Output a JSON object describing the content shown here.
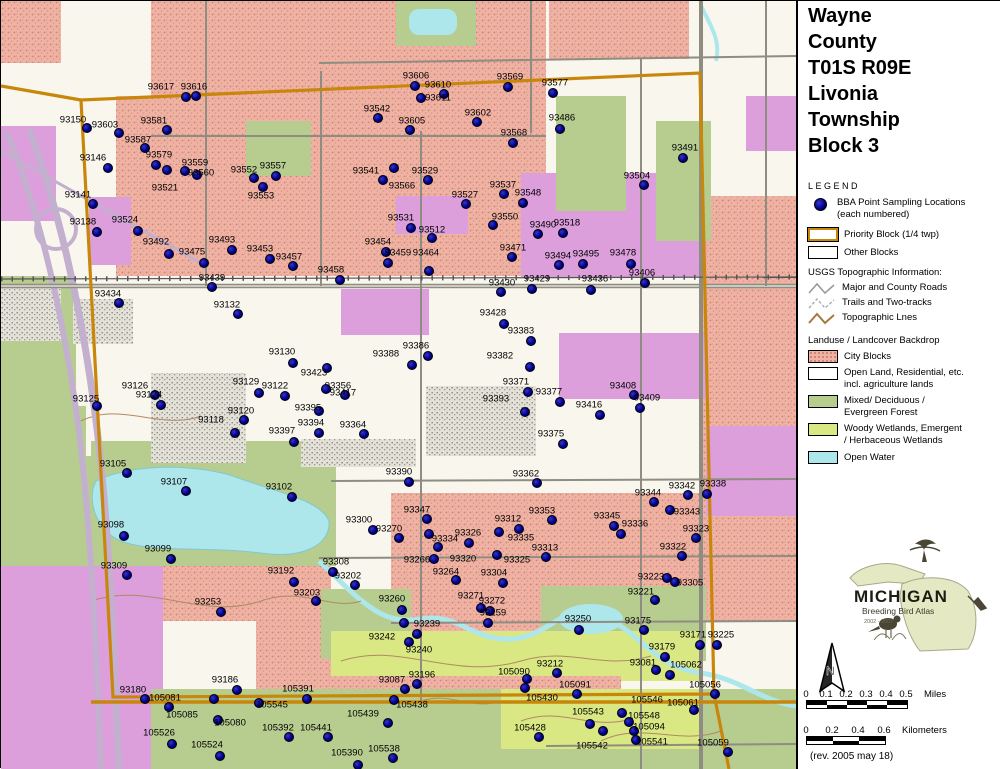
{
  "title": {
    "lines": [
      "Wayne",
      "County",
      "T01S R09E",
      "Livonia",
      "Township",
      "Block 3"
    ]
  },
  "legend": {
    "heading": "LEGEND",
    "points_label_line1": "BBA Point Sampling Locations",
    "points_label_line2": "(each numbered)",
    "priority_block_label": "Priority Block (1/4 twp)",
    "other_blocks_label": "Other Blocks",
    "usgs_heading": "USGS Topographic Information:",
    "usgs_items": [
      {
        "icon": "road-zigzag-icon",
        "label": "Major and County Roads"
      },
      {
        "icon": "trail-zigzag-icon",
        "label": "Trails and Two-tracks"
      },
      {
        "icon": "topo-zigzag-icon",
        "label": "Topographic Lnes"
      }
    ],
    "landuse_heading": "Landuse / Landcover Backdrop",
    "landuse_items": [
      {
        "swatch": "city-blocks",
        "line1": "City Blocks",
        "line2": ""
      },
      {
        "swatch": "open-land",
        "line1": "Open Land, Residential, etc.",
        "line2": "incl. agriculture lands"
      },
      {
        "swatch": "forest",
        "line1": "Mixed/ Deciduous /",
        "line2": "Evergreen Forest"
      },
      {
        "swatch": "wetland",
        "line1": "Woody Wetlands, Emergent",
        "line2": "/ Herbaceous Wetlands"
      },
      {
        "swatch": "open-water",
        "line1": "Open Water",
        "line2": ""
      }
    ]
  },
  "logo": {
    "name": "MICHIGAN",
    "subtitle": "Breeding Bird Atlas",
    "years": "2002 - 2007"
  },
  "north_arrow_label": "N",
  "scale": {
    "miles": {
      "ticks": [
        "0",
        "0.1",
        "0.2",
        "0.3",
        "0.4",
        "0.5"
      ],
      "unit": "Miles",
      "spacing": 20
    },
    "km": {
      "ticks": [
        "0",
        "0.2",
        "0.4",
        "0.6"
      ],
      "unit": "Kilometers",
      "spacing": 26
    }
  },
  "revision": "(rev. 2005 may 18)",
  "colors": {
    "map_background": "#f9f6ee",
    "city_blocks": "#f0b2a3",
    "city_speckle": "#d08275",
    "violet_blocks": "#dc9fdc",
    "forest": "#b7cd90",
    "wetland": "#d9e883",
    "open_water": "#ade7ec",
    "road_gray": "#8f8c82",
    "topo_brown": "#b08a64",
    "priority_boundary_orange": "#c8860a",
    "sample_point_blue": "#00008b"
  },
  "map": {
    "points": [
      [
        "93617",
        185,
        96,
        160,
        86
      ],
      [
        "93616",
        195,
        95,
        193,
        86
      ],
      [
        "93150",
        86,
        127,
        72,
        119
      ],
      [
        "93603",
        118,
        132,
        104,
        124
      ],
      [
        "93581",
        166,
        129,
        153,
        120
      ],
      [
        "93587",
        144,
        147,
        137,
        139
      ],
      [
        "93146",
        107,
        167,
        92,
        157
      ],
      [
        "93579",
        155,
        164,
        158,
        154
      ],
      [
        "93559",
        184,
        170,
        194,
        162
      ],
      [
        "93560",
        196,
        174,
        200,
        172
      ],
      [
        "93552",
        253,
        177,
        243,
        169
      ],
      [
        "93557",
        275,
        175,
        272,
        165
      ],
      [
        "93553",
        262,
        186,
        260,
        195
      ],
      [
        "93521",
        166,
        169,
        164,
        187
      ],
      [
        "93141",
        92,
        203,
        77,
        194
      ],
      [
        "93138",
        96,
        231,
        82,
        221
      ],
      [
        "93524",
        137,
        230,
        124,
        219
      ],
      [
        "93606",
        414,
        85,
        415,
        75
      ],
      [
        "93610",
        443,
        93,
        437,
        84
      ],
      [
        "93611",
        420,
        97,
        437,
        97
      ],
      [
        "93542",
        377,
        117,
        376,
        108
      ],
      [
        "93605",
        409,
        129,
        411,
        120
      ],
      [
        "93602",
        476,
        121,
        477,
        112
      ],
      [
        "93569",
        507,
        86,
        509,
        76
      ],
      [
        "93577",
        552,
        92,
        554,
        82
      ],
      [
        "93486",
        559,
        128,
        561,
        117
      ],
      [
        "93568",
        512,
        142,
        513,
        132
      ],
      [
        "93491",
        682,
        157,
        684,
        147
      ],
      [
        "93504",
        643,
        184,
        636,
        175
      ],
      [
        "93541",
        393,
        167,
        365,
        170
      ],
      [
        "93566",
        382,
        179,
        401,
        185
      ],
      [
        "93529",
        427,
        179,
        424,
        170
      ],
      [
        "93537",
        503,
        193,
        502,
        184
      ],
      [
        "93527",
        465,
        203,
        464,
        194
      ],
      [
        "93548",
        522,
        202,
        527,
        192
      ],
      [
        "93550",
        492,
        224,
        504,
        216
      ],
      [
        "93531",
        410,
        227,
        400,
        217
      ],
      [
        "93512",
        431,
        237,
        431,
        229
      ],
      [
        "93490",
        537,
        233,
        542,
        224
      ],
      [
        "93518",
        562,
        232,
        566,
        222
      ],
      [
        "93471",
        511,
        256,
        512,
        247
      ],
      [
        "93454",
        385,
        251,
        377,
        241
      ],
      [
        "93459",
        387,
        262,
        397,
        252
      ],
      [
        "93464",
        428,
        270,
        425,
        252
      ],
      [
        "93458",
        339,
        279,
        330,
        269
      ],
      [
        "93494",
        558,
        264,
        557,
        255
      ],
      [
        "93495",
        582,
        263,
        585,
        253
      ],
      [
        "93429",
        531,
        288,
        536,
        278
      ],
      [
        "93430",
        500,
        291,
        501,
        282
      ],
      [
        "93478",
        630,
        263,
        622,
        252
      ],
      [
        "93436",
        590,
        289,
        594,
        278
      ],
      [
        "93406",
        644,
        282,
        641,
        272
      ],
      [
        "93492",
        168,
        253,
        155,
        241
      ],
      [
        "93475",
        203,
        262,
        191,
        251
      ],
      [
        "93493",
        231,
        249,
        221,
        239
      ],
      [
        "93453",
        269,
        258,
        259,
        248
      ],
      [
        "93457",
        292,
        265,
        288,
        256
      ],
      [
        "93439",
        211,
        286,
        211,
        277
      ],
      [
        "93434",
        118,
        302,
        107,
        293
      ],
      [
        "93132",
        237,
        313,
        226,
        304
      ],
      [
        "93130",
        292,
        362,
        281,
        351
      ],
      [
        "93129",
        258,
        392,
        245,
        381
      ],
      [
        "93122",
        284,
        395,
        274,
        385
      ],
      [
        "93126",
        154,
        394,
        134,
        385
      ],
      [
        "93124",
        160,
        404,
        148,
        394
      ],
      [
        "93125",
        96,
        405,
        85,
        398
      ],
      [
        "93120",
        243,
        419,
        240,
        410
      ],
      [
        "93118",
        234,
        432,
        210,
        419
      ],
      [
        "93423",
        326,
        367,
        313,
        372
      ],
      [
        "93356",
        344,
        394,
        337,
        385
      ],
      [
        "93417",
        325,
        388,
        342,
        392
      ],
      [
        "93395",
        318,
        410,
        307,
        407
      ],
      [
        "93394",
        318,
        432,
        310,
        422
      ],
      [
        "93397",
        293,
        441,
        281,
        430
      ],
      [
        "93364",
        363,
        433,
        352,
        424
      ],
      [
        "93386",
        427,
        355,
        415,
        345
      ],
      [
        "93388",
        411,
        364,
        385,
        353
      ],
      [
        "93383",
        530,
        340,
        520,
        330
      ],
      [
        "93382",
        529,
        366,
        499,
        355
      ],
      [
        "93428",
        503,
        323,
        492,
        312
      ],
      [
        "93371",
        527,
        391,
        515,
        381
      ],
      [
        "93377",
        559,
        401,
        548,
        391
      ],
      [
        "93393",
        524,
        411,
        495,
        398
      ],
      [
        "93375",
        562,
        443,
        550,
        433
      ],
      [
        "93362",
        536,
        482,
        525,
        473
      ],
      [
        "93390",
        408,
        481,
        398,
        471
      ],
      [
        "93408",
        633,
        394,
        622,
        385
      ],
      [
        "93409",
        639,
        407,
        646,
        397
      ],
      [
        "93416",
        599,
        414,
        588,
        404
      ],
      [
        "93105",
        126,
        472,
        112,
        463
      ],
      [
        "93107",
        185,
        490,
        173,
        481
      ],
      [
        "93102",
        291,
        496,
        278,
        486
      ],
      [
        "93098",
        123,
        535,
        110,
        524
      ],
      [
        "93099",
        170,
        558,
        157,
        548
      ],
      [
        "93309",
        126,
        574,
        113,
        565
      ],
      [
        "93192",
        293,
        581,
        280,
        570
      ],
      [
        "93203",
        315,
        600,
        306,
        592
      ],
      [
        "93253",
        220,
        611,
        207,
        601
      ],
      [
        "93300",
        372,
        529,
        358,
        519
      ],
      [
        "93270",
        398,
        537,
        388,
        528
      ],
      [
        "93347",
        426,
        518,
        416,
        509
      ],
      [
        "93312",
        518,
        528,
        507,
        518
      ],
      [
        "93353",
        551,
        519,
        541,
        510
      ],
      [
        "93334",
        428,
        533,
        444,
        538
      ],
      [
        "93326",
        468,
        542,
        467,
        532
      ],
      [
        "93335",
        498,
        531,
        520,
        537
      ],
      [
        "93313",
        545,
        556,
        544,
        547
      ],
      [
        "93266",
        433,
        558,
        416,
        559
      ],
      [
        "93320",
        437,
        546,
        462,
        558
      ],
      [
        "93325",
        496,
        554,
        516,
        559
      ],
      [
        "93264",
        455,
        579,
        445,
        571
      ],
      [
        "93304",
        502,
        582,
        493,
        572
      ],
      [
        "93308",
        332,
        571,
        335,
        561
      ],
      [
        "93202",
        354,
        584,
        347,
        575
      ],
      [
        "93260",
        401,
        609,
        391,
        598
      ],
      [
        "93271",
        480,
        607,
        470,
        595
      ],
      [
        "93272",
        489,
        610,
        491,
        600
      ],
      [
        "93259",
        487,
        622,
        492,
        612
      ],
      [
        "93239",
        403,
        622,
        426,
        623
      ],
      [
        "93250",
        578,
        629,
        577,
        618
      ],
      [
        "93242",
        408,
        641,
        381,
        636
      ],
      [
        "93240",
        416,
        633,
        418,
        649
      ],
      [
        "93342",
        687,
        494,
        681,
        485
      ],
      [
        "93338",
        706,
        493,
        712,
        483
      ],
      [
        "93344",
        653,
        501,
        647,
        492
      ],
      [
        "93343",
        669,
        509,
        686,
        511
      ],
      [
        "93345",
        613,
        525,
        606,
        515
      ],
      [
        "93336",
        620,
        533,
        634,
        523
      ],
      [
        "93323",
        695,
        537,
        695,
        528
      ],
      [
        "93322",
        681,
        555,
        672,
        546
      ],
      [
        "93223",
        666,
        577,
        650,
        576
      ],
      [
        "93305",
        674,
        581,
        689,
        582
      ],
      [
        "93221",
        654,
        599,
        640,
        591
      ],
      [
        "93175",
        643,
        629,
        637,
        620
      ],
      [
        "93171",
        699,
        644,
        692,
        634
      ],
      [
        "93225",
        716,
        644,
        720,
        634
      ],
      [
        "93179",
        664,
        656,
        661,
        646
      ],
      [
        "93081",
        655,
        669,
        642,
        662
      ],
      [
        "105062",
        669,
        674,
        685,
        664
      ],
      [
        "105056",
        714,
        693,
        704,
        684
      ],
      [
        "105061",
        693,
        709,
        682,
        702
      ],
      [
        "105546",
        621,
        712,
        646,
        699
      ],
      [
        "105548",
        628,
        721,
        643,
        715
      ],
      [
        "105094",
        633,
        730,
        648,
        726
      ],
      [
        "105541",
        635,
        739,
        651,
        741
      ],
      [
        "105059",
        727,
        751,
        712,
        742
      ],
      [
        "105542",
        602,
        730,
        591,
        745
      ],
      [
        "93087",
        404,
        688,
        391,
        679
      ],
      [
        "93196",
        416,
        683,
        421,
        674
      ],
      [
        "105438",
        393,
        699,
        411,
        704
      ],
      [
        "105439",
        387,
        722,
        362,
        713
      ],
      [
        "105538",
        392,
        757,
        383,
        748
      ],
      [
        "105390",
        357,
        764,
        346,
        752
      ],
      [
        "105090",
        526,
        678,
        513,
        671
      ],
      [
        "93212",
        556,
        672,
        549,
        663
      ],
      [
        "105091",
        576,
        693,
        574,
        684
      ],
      [
        "105430",
        524,
        687,
        541,
        697
      ],
      [
        "105543",
        589,
        723,
        587,
        711
      ],
      [
        "105428",
        538,
        736,
        529,
        727
      ],
      [
        "105441",
        327,
        736,
        315,
        727
      ],
      [
        "105392",
        288,
        736,
        277,
        727
      ],
      [
        "93186",
        236,
        689,
        224,
        679
      ],
      [
        "93180",
        144,
        698,
        132,
        689
      ],
      [
        "105081",
        168,
        706,
        164,
        697
      ],
      [
        "105391",
        306,
        698,
        297,
        688
      ],
      [
        "105545",
        258,
        702,
        271,
        704
      ],
      [
        "105085",
        213,
        698,
        181,
        714
      ],
      [
        "105080",
        217,
        719,
        229,
        722
      ],
      [
        "105526",
        171,
        743,
        158,
        732
      ],
      [
        "105524",
        219,
        755,
        206,
        744
      ]
    ]
  }
}
